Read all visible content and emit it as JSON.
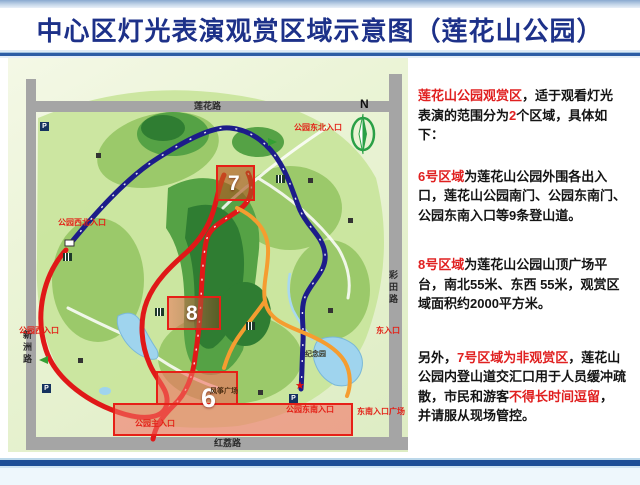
{
  "title": "中心区灯光表演观赏区域示意图（莲花山公园）",
  "info": {
    "p1": {
      "s1": "莲花山公园观赏区",
      "s2": "，适于观看灯光表演的范围分为",
      "s3": "2",
      "s4": "个区域，具体如下："
    },
    "p2": {
      "s1": "6号区域",
      "s2": "为莲花山公园外围各出入口，莲花山公园南门、公园东南门、公园东南入口等9条登山道。"
    },
    "p3": {
      "s1": "8号区域",
      "s2": "为莲花山公园山顶广场平台，南北55米、东西 55米，观赏区域面积约2000平方米。"
    },
    "p4": {
      "s1": "另外，",
      "s2": "7号区域为非观赏区",
      "s3": "，莲花山公园内登山道交汇口用于人员缓冲疏散，市民和游客",
      "s4": "不得长时间逗留",
      "s5": "，并请服从现场管控。"
    }
  },
  "map": {
    "compass_label": "N",
    "roads": {
      "top": "莲花路",
      "left": "新洲路",
      "right": "彩田路",
      "bottom": "红荔路"
    },
    "entrances": {
      "northeast": "公园东北入口",
      "northwest": "公园西北入口",
      "west": "公园西入口",
      "east": "东入口",
      "main": "公园主入口",
      "southeast": "公园东南入口",
      "southeast_plaza": "东南入口广场"
    },
    "landmarks": {
      "memorial": "纪念园",
      "kite_plaza": "风筝广场"
    },
    "zones": {
      "zone6": "6",
      "zone7": "7",
      "zone8": "8"
    },
    "icons": {
      "parking": "P",
      "star": "★"
    }
  },
  "colors": {
    "title_navy": "#1d3189",
    "accent_red": "#e32117",
    "navy_path": "#1c1c8a",
    "red_path": "#e01818",
    "orange_path": "#f59d30",
    "road_gray": "#a5a5a5",
    "bar_blue": "#2d5da5"
  }
}
